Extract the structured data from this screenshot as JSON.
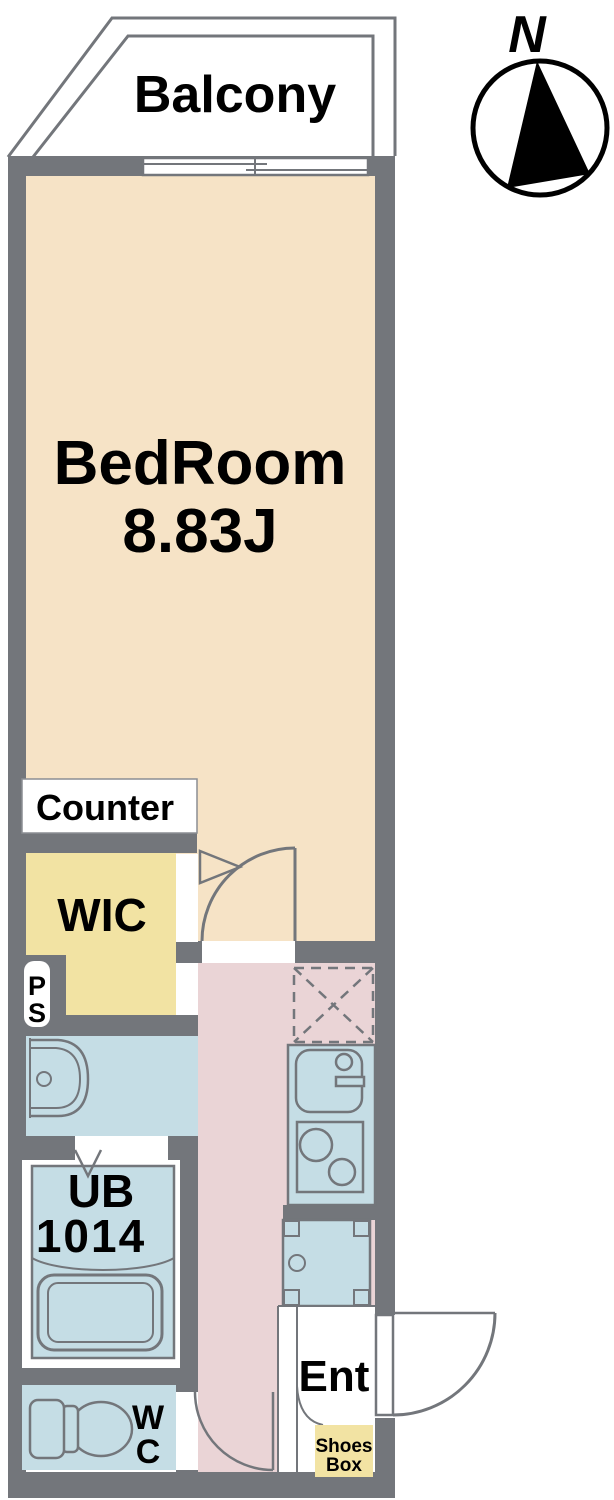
{
  "plan": {
    "balcony": {
      "label": "Balcony"
    },
    "compass": {
      "north_label": "N"
    },
    "bedroom": {
      "name": "BedRoom",
      "size": "8.83J"
    },
    "counter": {
      "label": "Counter"
    },
    "wic": {
      "label": "WIC"
    },
    "pipe_space": {
      "line1": "P",
      "line2": "S"
    },
    "unit_bath": {
      "name": "UB",
      "size": "1014"
    },
    "toilet_room": {
      "line1": "W",
      "line2": "C"
    },
    "entrance": {
      "label": "Ent"
    },
    "shoes_box": {
      "line1": "Shoes",
      "line2": "Box"
    }
  },
  "colors": {
    "wall": "#73767B",
    "bedroom": "#F6E3C6",
    "corridor": "#EAD4D6",
    "closet": "#F2E3A3",
    "wet": "#C5DDE5",
    "outline": "#73767B",
    "text": "#000000",
    "paper": "#FFFFFF"
  }
}
